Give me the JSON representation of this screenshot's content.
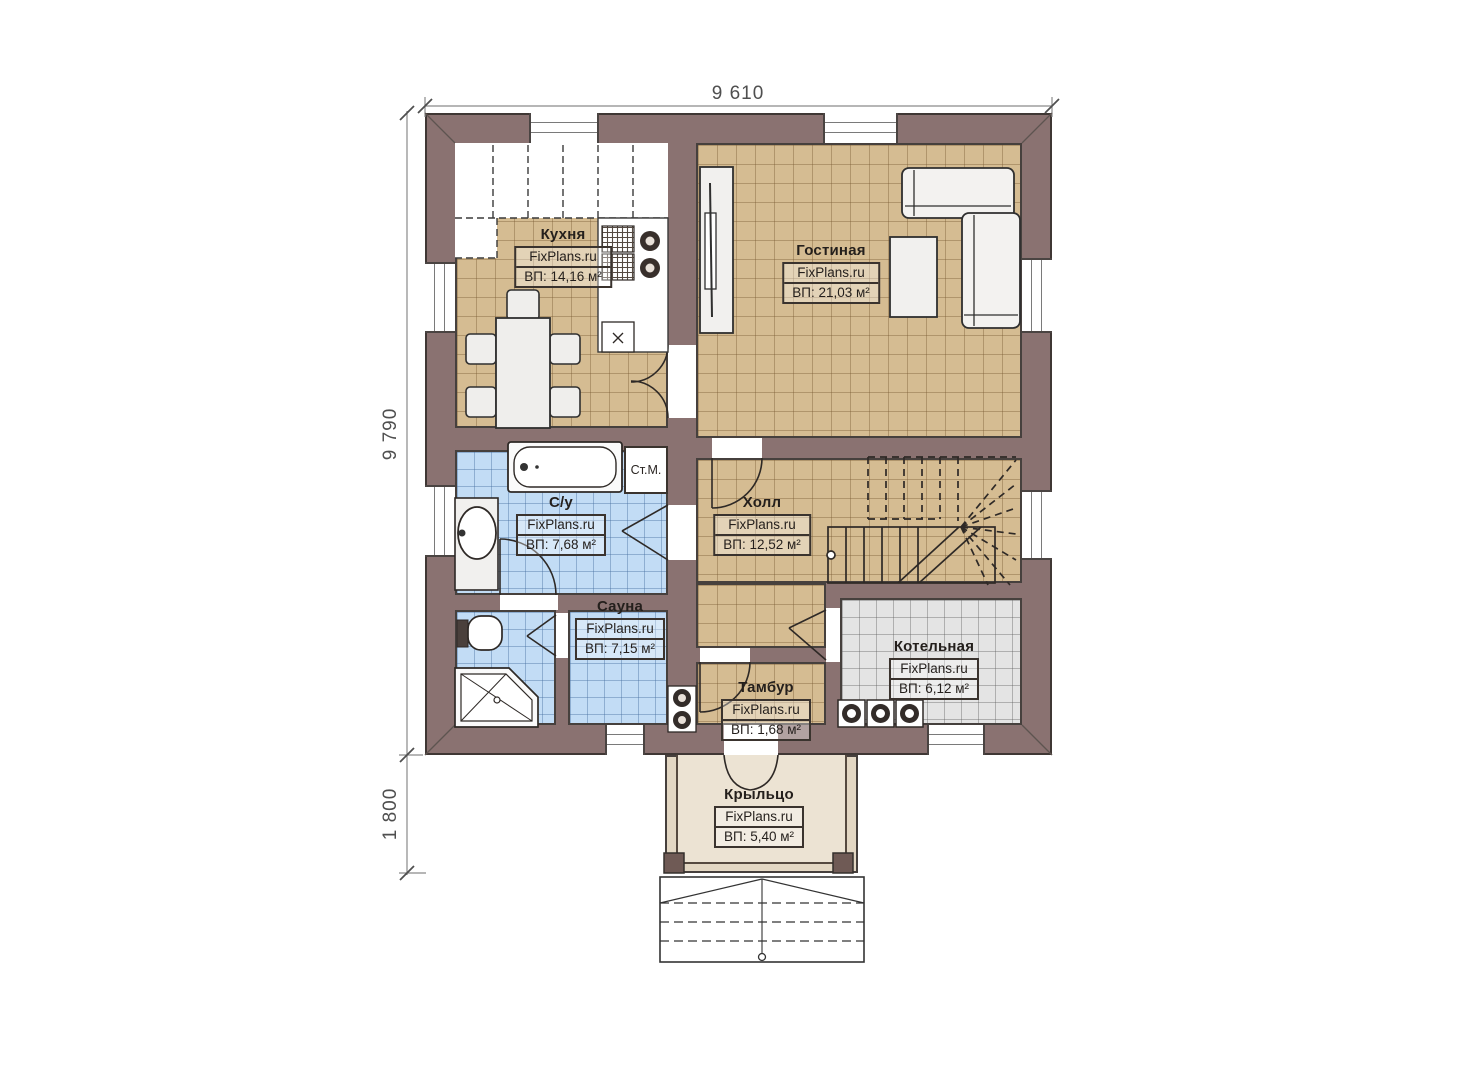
{
  "plan": {
    "title_hint": "single floor plan drawing",
    "dimensions": {
      "width_top": "9 610",
      "height_left": "9 790",
      "porch_depth": "1 800"
    },
    "rooms": [
      {
        "id": "kitchen",
        "name": "Кухня",
        "brand": "FixPlans.ru",
        "area": "ВП: 14,16 м²"
      },
      {
        "id": "living",
        "name": "Гостиная",
        "brand": "FixPlans.ru",
        "area": "ВП: 21,03 м²"
      },
      {
        "id": "bathroom",
        "name": "С/у",
        "brand": "FixPlans.ru",
        "area": "ВП: 7,68 м²"
      },
      {
        "id": "hall",
        "name": "Холл",
        "brand": "FixPlans.ru",
        "area": "ВП: 12,52 м²"
      },
      {
        "id": "sauna",
        "name": "Сауна",
        "brand": "FixPlans.ru",
        "area": "ВП: 7,15 м²"
      },
      {
        "id": "tambour",
        "name": "Тамбур",
        "brand": "FixPlans.ru",
        "area": "ВП: 1,68 м²"
      },
      {
        "id": "boiler",
        "name": "Котельная",
        "brand": "FixPlans.ru",
        "area": "ВП: 6,12 м²"
      },
      {
        "id": "porch",
        "name": "Крыльцо",
        "brand": "FixPlans.ru",
        "area": "ВП: 5,40 м²"
      }
    ],
    "appliances": {
      "washing_machine": "Ст.М."
    },
    "colors": {
      "wall": "#8a7271",
      "floor_wood": "#d5bc92",
      "floor_tile_blue": "#c2dcf5",
      "floor_tile_gray": "#e4e4e4",
      "floor_porch": "#ece3d3",
      "line": "#2e2926",
      "dimension_text": "#4f4f4f"
    }
  }
}
